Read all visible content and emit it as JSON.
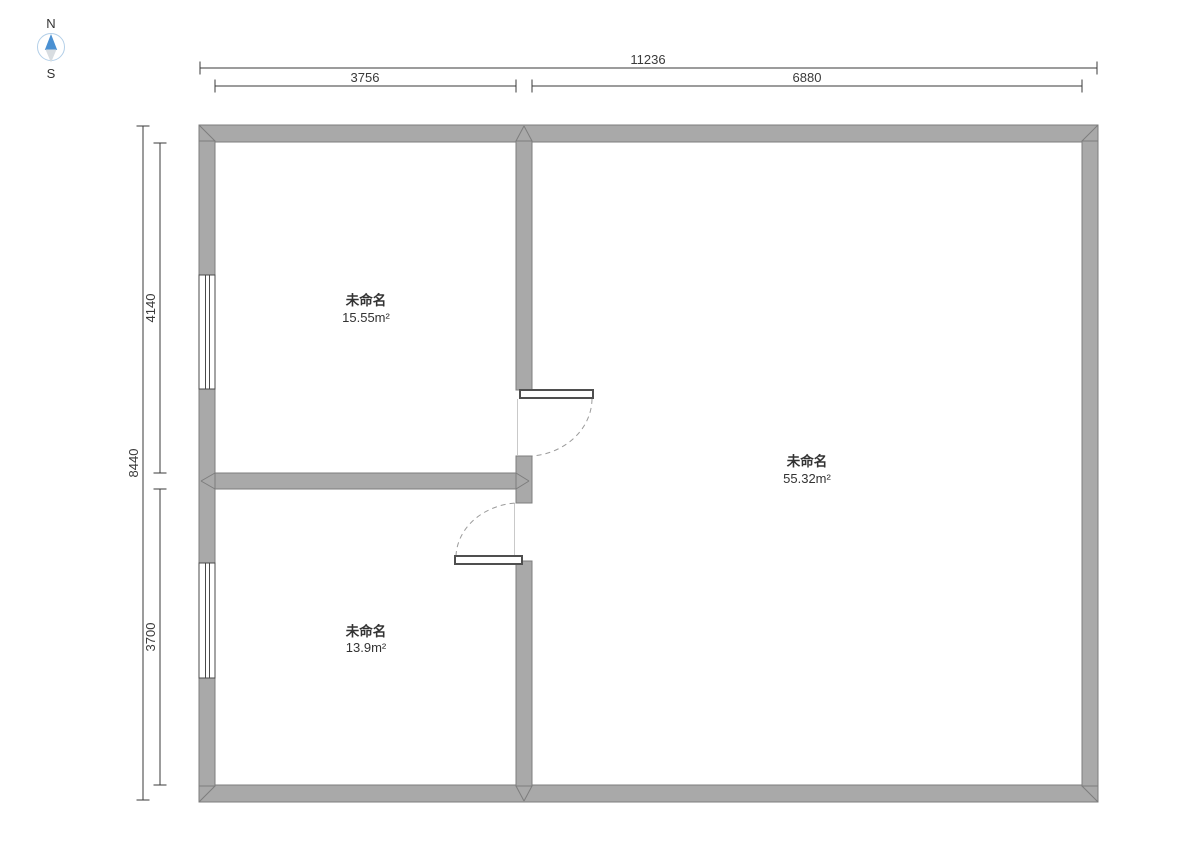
{
  "compass": {
    "north_label": "N",
    "south_label": "S"
  },
  "dimensions": {
    "top_total": "11236",
    "top_left": "3756",
    "top_right": "6880",
    "left_total": "8440",
    "left_upper": "4140",
    "left_lower": "3700"
  },
  "rooms": [
    {
      "name": "未命名",
      "area": "15.55m²"
    },
    {
      "name": "未命名",
      "area": "55.32m²"
    },
    {
      "name": "未命名",
      "area": "13.9m²"
    }
  ],
  "colors": {
    "wall_fill": "#a9a9a9",
    "wall_stroke": "#7d7d7d",
    "window_stroke": "#4a4a4a",
    "door_stroke": "#4f4f4f",
    "door_arc": "#9b9b9b",
    "dimension": "#3a3a3a",
    "text": "#333333",
    "compass_north": "#4a90d2",
    "compass_south": "#d8dde1",
    "compass_ring": "#b3cfe8"
  }
}
